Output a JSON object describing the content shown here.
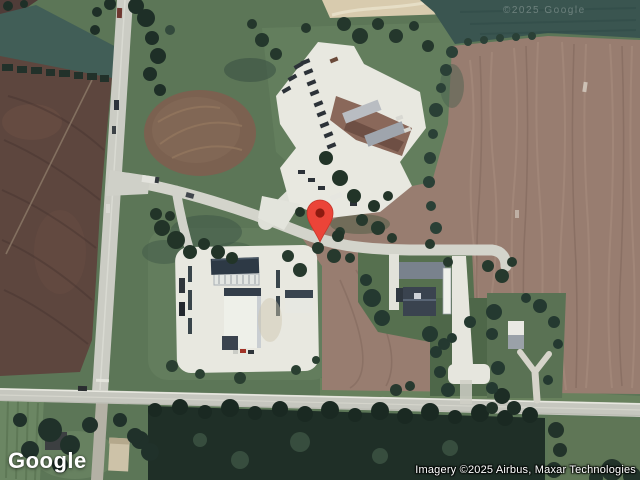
{
  "branding": {
    "logo_text": "Google"
  },
  "attribution": {
    "text": "Imagery ©2025 Airbus, Maxar Technologies"
  },
  "watermark": {
    "text": "©2025 Google"
  },
  "marker": {
    "label": "location-pin",
    "color": "#EB4438",
    "inner_color": "#8E1A10"
  },
  "map": {
    "view": "satellite",
    "palette": {
      "grass": "#5c7657",
      "plowed_field_left": "#5d463e",
      "plowed_field_right": "#987d70",
      "dark_teal_field": "#3c5752",
      "road": "#cbccc3",
      "pavement": "#e8e8e0",
      "forest": "#1f2f27"
    }
  }
}
